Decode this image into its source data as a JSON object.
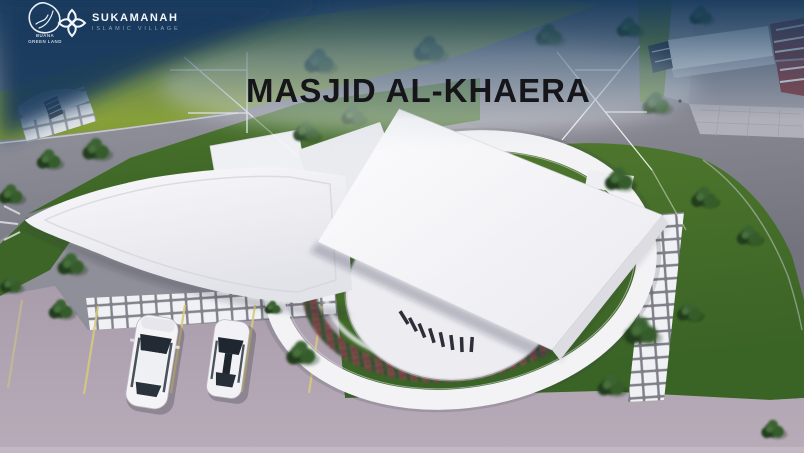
{
  "header": {
    "developer_logo": {
      "line1": "BUANA",
      "line2": "GREEN LAND"
    },
    "brand": {
      "name": "SUKAMANAH",
      "tagline": "ISLAMIC VILLAGE"
    }
  },
  "title": "MASJID AL-KHAERA",
  "scene": {
    "type": "aerial-3d-architectural-render",
    "subject": "Mosque site plan: circular prayer hall under a tilted white square roof canopy, ringed flower bed and curved white perimeter walkway, wedge-shaped entrance building, lawns with trees, grid paving paths, parking lot with two white cars, access roads and neighbouring houses",
    "colors": {
      "sky_navy": "#1b4164",
      "grass_bright": "#a6b743",
      "grass_dark": "#3f6b2b",
      "road_gray": "#82828c",
      "pavement_lavender": "#b5a9b7",
      "building_white": "#f5f5f7",
      "house_roof_maroon": "#7c4048",
      "flowerbed_red": "#7c3b44",
      "parking_line_yellow": "#d8c87e",
      "annotation_line": "#ffffff",
      "title_color": "#15151a"
    }
  }
}
